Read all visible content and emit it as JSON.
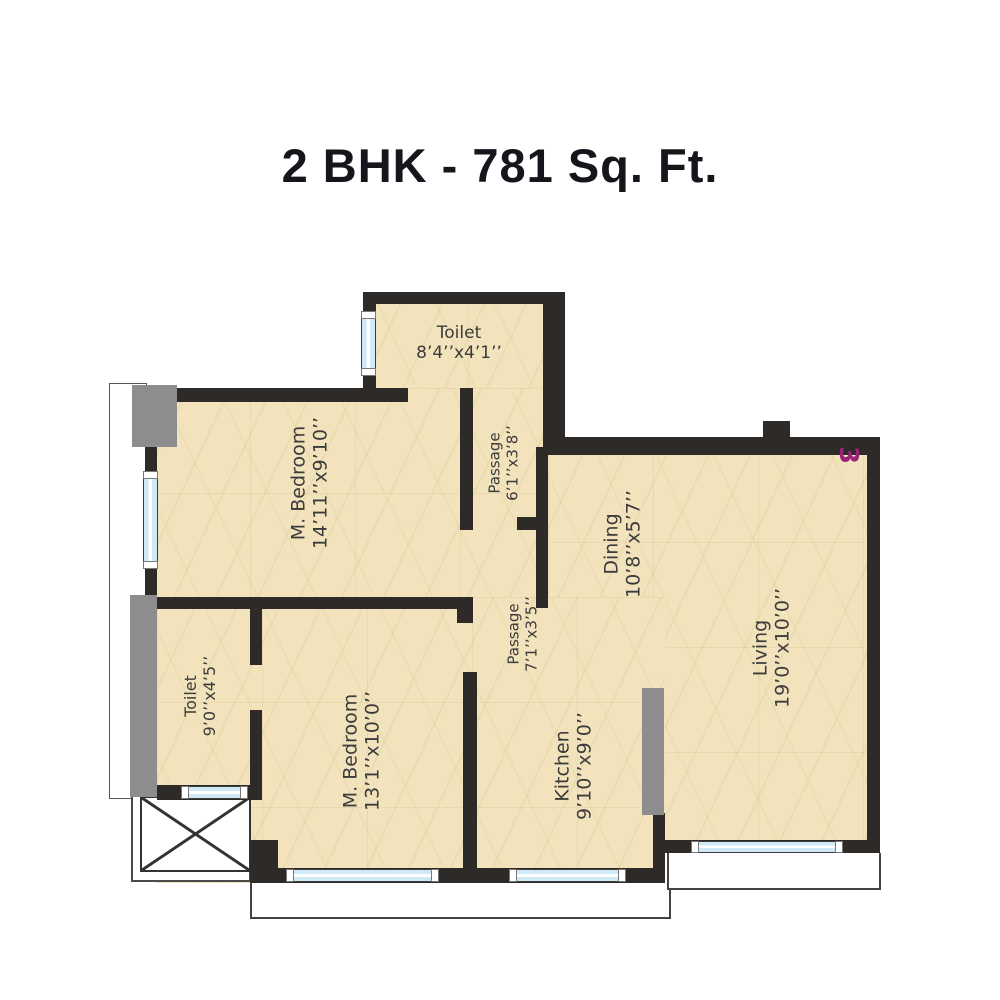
{
  "title": "2 BHK - 781 Sq. Ft.",
  "unit_number": "3",
  "colors": {
    "wall": "#2e2a27",
    "floor": "#f2e3bc",
    "window_glass": "#cfe9f7",
    "duct_gray": "#8d8d8d",
    "unit_number_text": "#9c2277",
    "label_text": "#3b3b3b",
    "title_text": "#15151c"
  },
  "rooms": [
    {
      "id": "toilet-top",
      "name": "Toilet",
      "dims": "8’4’’x4’1’’",
      "orientation": "horizontal"
    },
    {
      "id": "m-bedroom-1",
      "name": "M. Bedroom",
      "dims": "14’11’’x9’10’’",
      "orientation": "vertical"
    },
    {
      "id": "passage-1",
      "name": "Passage",
      "dims": "6’1’’x3’8’’",
      "orientation": "vertical"
    },
    {
      "id": "dining",
      "name": "Dining",
      "dims": "10’8’’x5’7’’",
      "orientation": "vertical"
    },
    {
      "id": "living",
      "name": "Living",
      "dims": "19’0’’x10’0’’",
      "orientation": "vertical"
    },
    {
      "id": "passage-2",
      "name": "Passage",
      "dims": "7’1’’x3’5’’",
      "orientation": "vertical"
    },
    {
      "id": "toilet-left",
      "name": "Toilet",
      "dims": "9’0’’x4’5’’",
      "orientation": "vertical"
    },
    {
      "id": "m-bedroom-2",
      "name": "M. Bedroom",
      "dims": "13’1’’x10’0’’",
      "orientation": "vertical"
    },
    {
      "id": "kitchen",
      "name": "Kitchen",
      "dims": "9’10’’x9’0’’",
      "orientation": "vertical"
    }
  ]
}
